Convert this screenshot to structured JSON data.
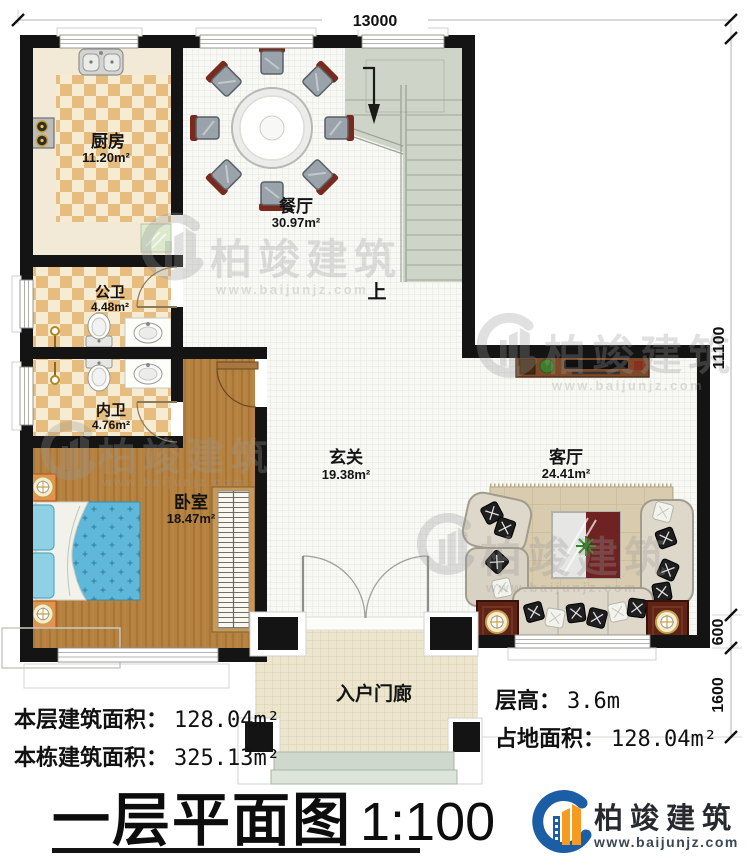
{
  "plan": {
    "sheet_title": "一层平面图",
    "sheet_scale": "1:100",
    "dimension_top": "13000",
    "dimension_right_main": "11100",
    "dimension_right_mid": "600",
    "dimension_right_porch": "1600",
    "stairs_up": "上",
    "rooms": {
      "kitchen": {
        "name": "厨房",
        "area": "11.20m²"
      },
      "dining": {
        "name": "餐厅",
        "area": "30.97m²"
      },
      "public_bath": {
        "name": "公卫",
        "area": "4.48m²"
      },
      "inner_bath": {
        "name": "内卫",
        "area": "4.76m²"
      },
      "bedroom": {
        "name": "卧室",
        "area": "18.47m²"
      },
      "foyer": {
        "name": "玄关",
        "area": "19.38m²"
      },
      "living": {
        "name": "客厅",
        "area": "24.41m²"
      },
      "porch": {
        "name": "入户门廊"
      }
    },
    "info": {
      "floor_area_label": "本层建筑面积：",
      "floor_area_value": "128.04m²",
      "total_area_label": "本栋建筑面积：",
      "total_area_value": "325.13m²",
      "height_label": "层高：",
      "height_value": "3.6m",
      "footprint_label": "占地面积：",
      "footprint_value": "128.04m²"
    },
    "brand": {
      "name": "柏竣建筑",
      "url": "www.baijunjz.com"
    },
    "colors": {
      "wall": "#141414",
      "wood_floor": "#b5813f",
      "tile_tan": "#e6bd7e",
      "accent_blue": "#1b5ea6",
      "accent_orange": "#f59b20"
    }
  }
}
